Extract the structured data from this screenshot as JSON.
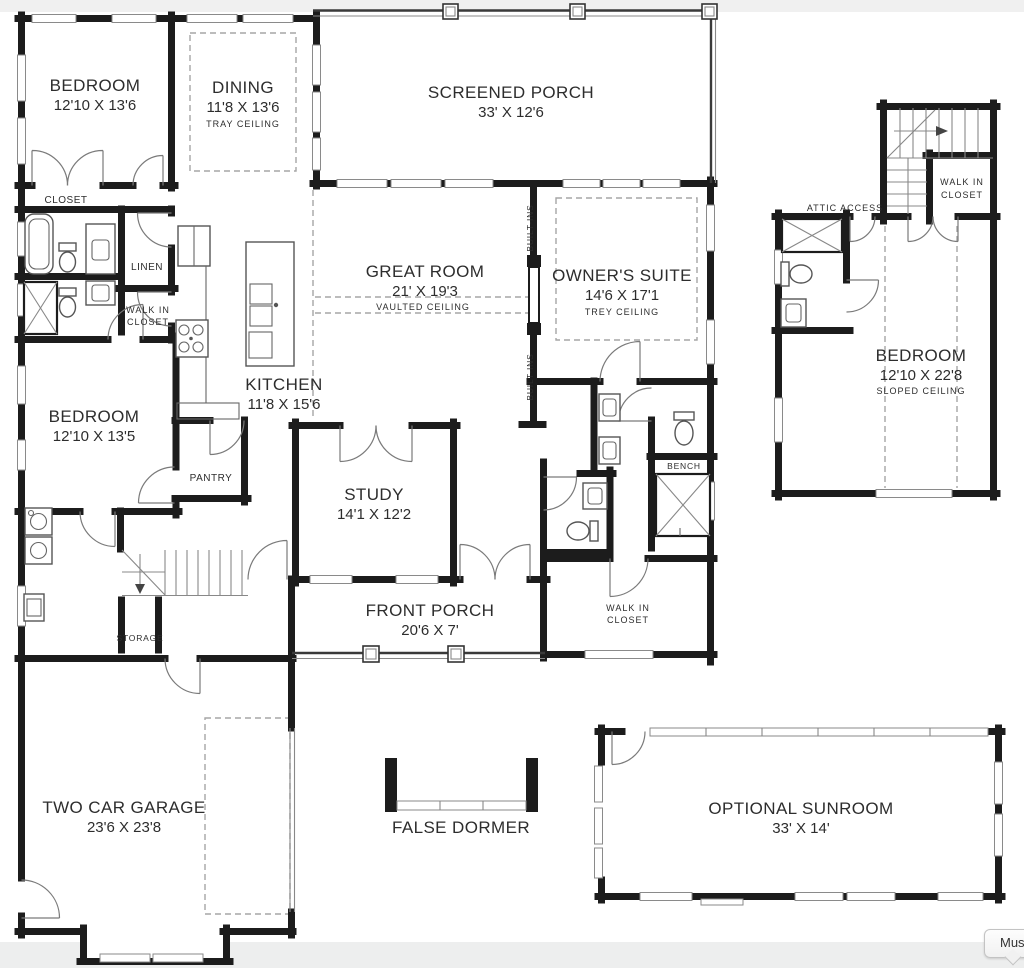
{
  "page": {
    "tooltip_text": "Mus"
  },
  "rooms": {
    "bedroom_top": {
      "name": "BEDROOM",
      "dims": "12'10 X 13'6"
    },
    "dining": {
      "name": "DINING",
      "dims": "11'8 X 13'6",
      "note": "TRAY CEILING"
    },
    "screened_porch": {
      "name": "SCREENED PORCH",
      "dims": "33' X 12'6"
    },
    "great_room": {
      "name": "GREAT ROOM",
      "dims": "21' X 19'3",
      "note": "VAULTED CEILING"
    },
    "owners_suite": {
      "name": "OWNER'S SUITE",
      "dims": "14'6 X 17'1",
      "note": "TREY CEILING"
    },
    "kitchen": {
      "name": "KITCHEN",
      "dims": "11'8 X 15'6"
    },
    "bedroom_left": {
      "name": "BEDROOM",
      "dims": "12'10 X 13'5"
    },
    "study": {
      "name": "STUDY",
      "dims": "14'1 X 12'2"
    },
    "front_porch": {
      "name": "FRONT PORCH",
      "dims": "20'6 X 7'"
    },
    "garage": {
      "name": "TWO CAR GARAGE",
      "dims": "23'6 X 23'8"
    },
    "false_dormer": {
      "name": "FALSE DORMER"
    },
    "sunroom": {
      "name": "OPTIONAL SUNROOM",
      "dims": "33' X 14'"
    },
    "bonus_bedroom": {
      "name": "BEDROOM",
      "dims": "12'10 X 22'8",
      "note": "SLOPED CEILING"
    }
  },
  "labels": {
    "closet": "CLOSET",
    "linen": "LINEN",
    "pantry": "PANTRY",
    "bench": "BENCH",
    "storage": "STORAGE",
    "attic_access": "ATTIC ACCESS",
    "built_ins": "BUILT-INS",
    "walk_in_line1": "WALK IN",
    "walk_in_line2": "CLOSET"
  }
}
